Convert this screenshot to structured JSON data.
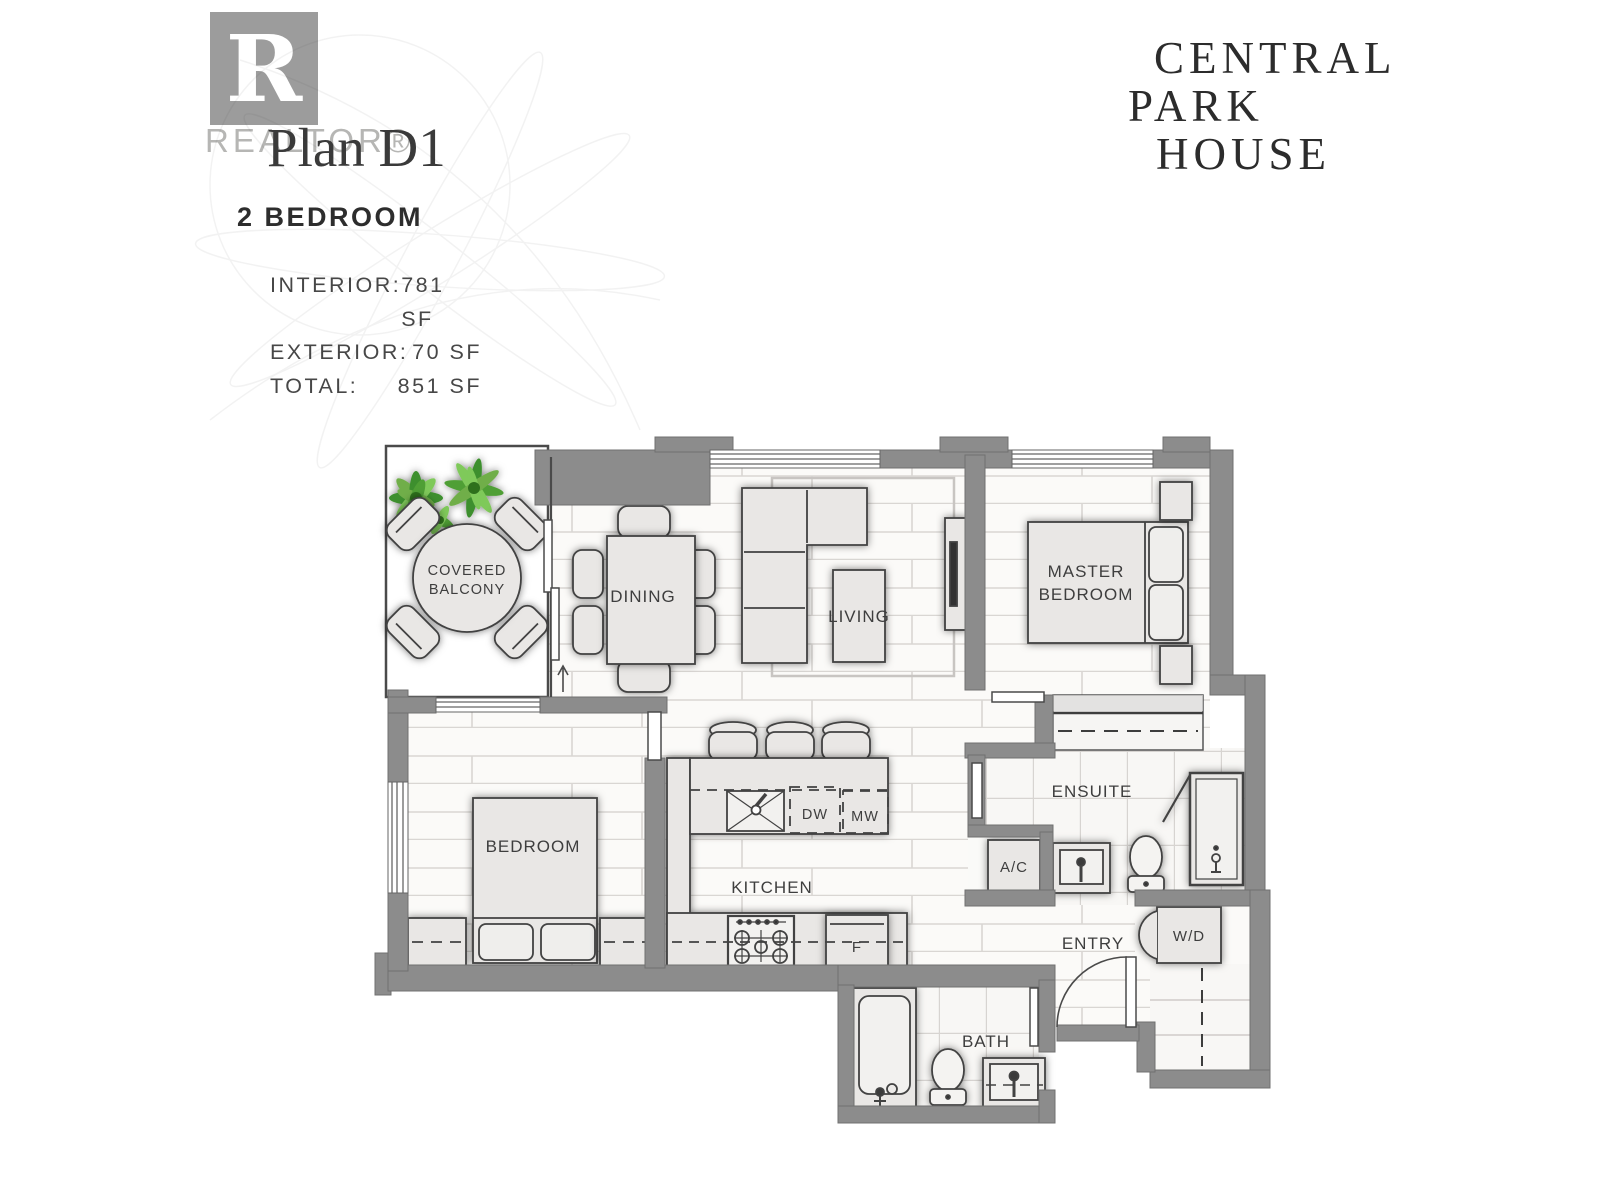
{
  "header": {
    "realtor": {
      "letter": "R",
      "wordmark": "REALTOR®"
    },
    "plan_title": "Plan D1",
    "unit_type": "2 BEDROOM",
    "stats": [
      {
        "label": "INTERIOR:",
        "value": "781 SF"
      },
      {
        "label": "EXTERIOR:",
        "value": "70 SF"
      },
      {
        "label": "TOTAL:",
        "value": "851 SF"
      }
    ],
    "brand": {
      "line1": "CENTRAL",
      "line2": "PARK",
      "line3": "HOUSE"
    }
  },
  "floorplan": {
    "rooms": {
      "covered_balcony": {
        "label_line1": "COVERED",
        "label_line2": "BALCONY"
      },
      "dining": {
        "label": "DINING"
      },
      "living": {
        "label": "LIVING"
      },
      "master_bedroom": {
        "label_line1": "MASTER",
        "label_line2": "BEDROOM"
      },
      "bedroom": {
        "label": "BEDROOM"
      },
      "kitchen": {
        "label": "KITCHEN"
      },
      "ensuite": {
        "label": "ENSUITE"
      },
      "entry": {
        "label": "ENTRY"
      },
      "bath": {
        "label": "BATH"
      }
    },
    "appliances": {
      "dishwasher": "DW",
      "microwave": "MW",
      "fridge": "F",
      "ac": "A/C",
      "washer_dryer": "W/D"
    },
    "colors": {
      "wall": "#8c8c8c",
      "furniture_fill": "#e9e7e5",
      "outline": "#424242",
      "plant_green_dark": "#3e8f2e",
      "plant_green_light": "#7fc95a"
    }
  }
}
